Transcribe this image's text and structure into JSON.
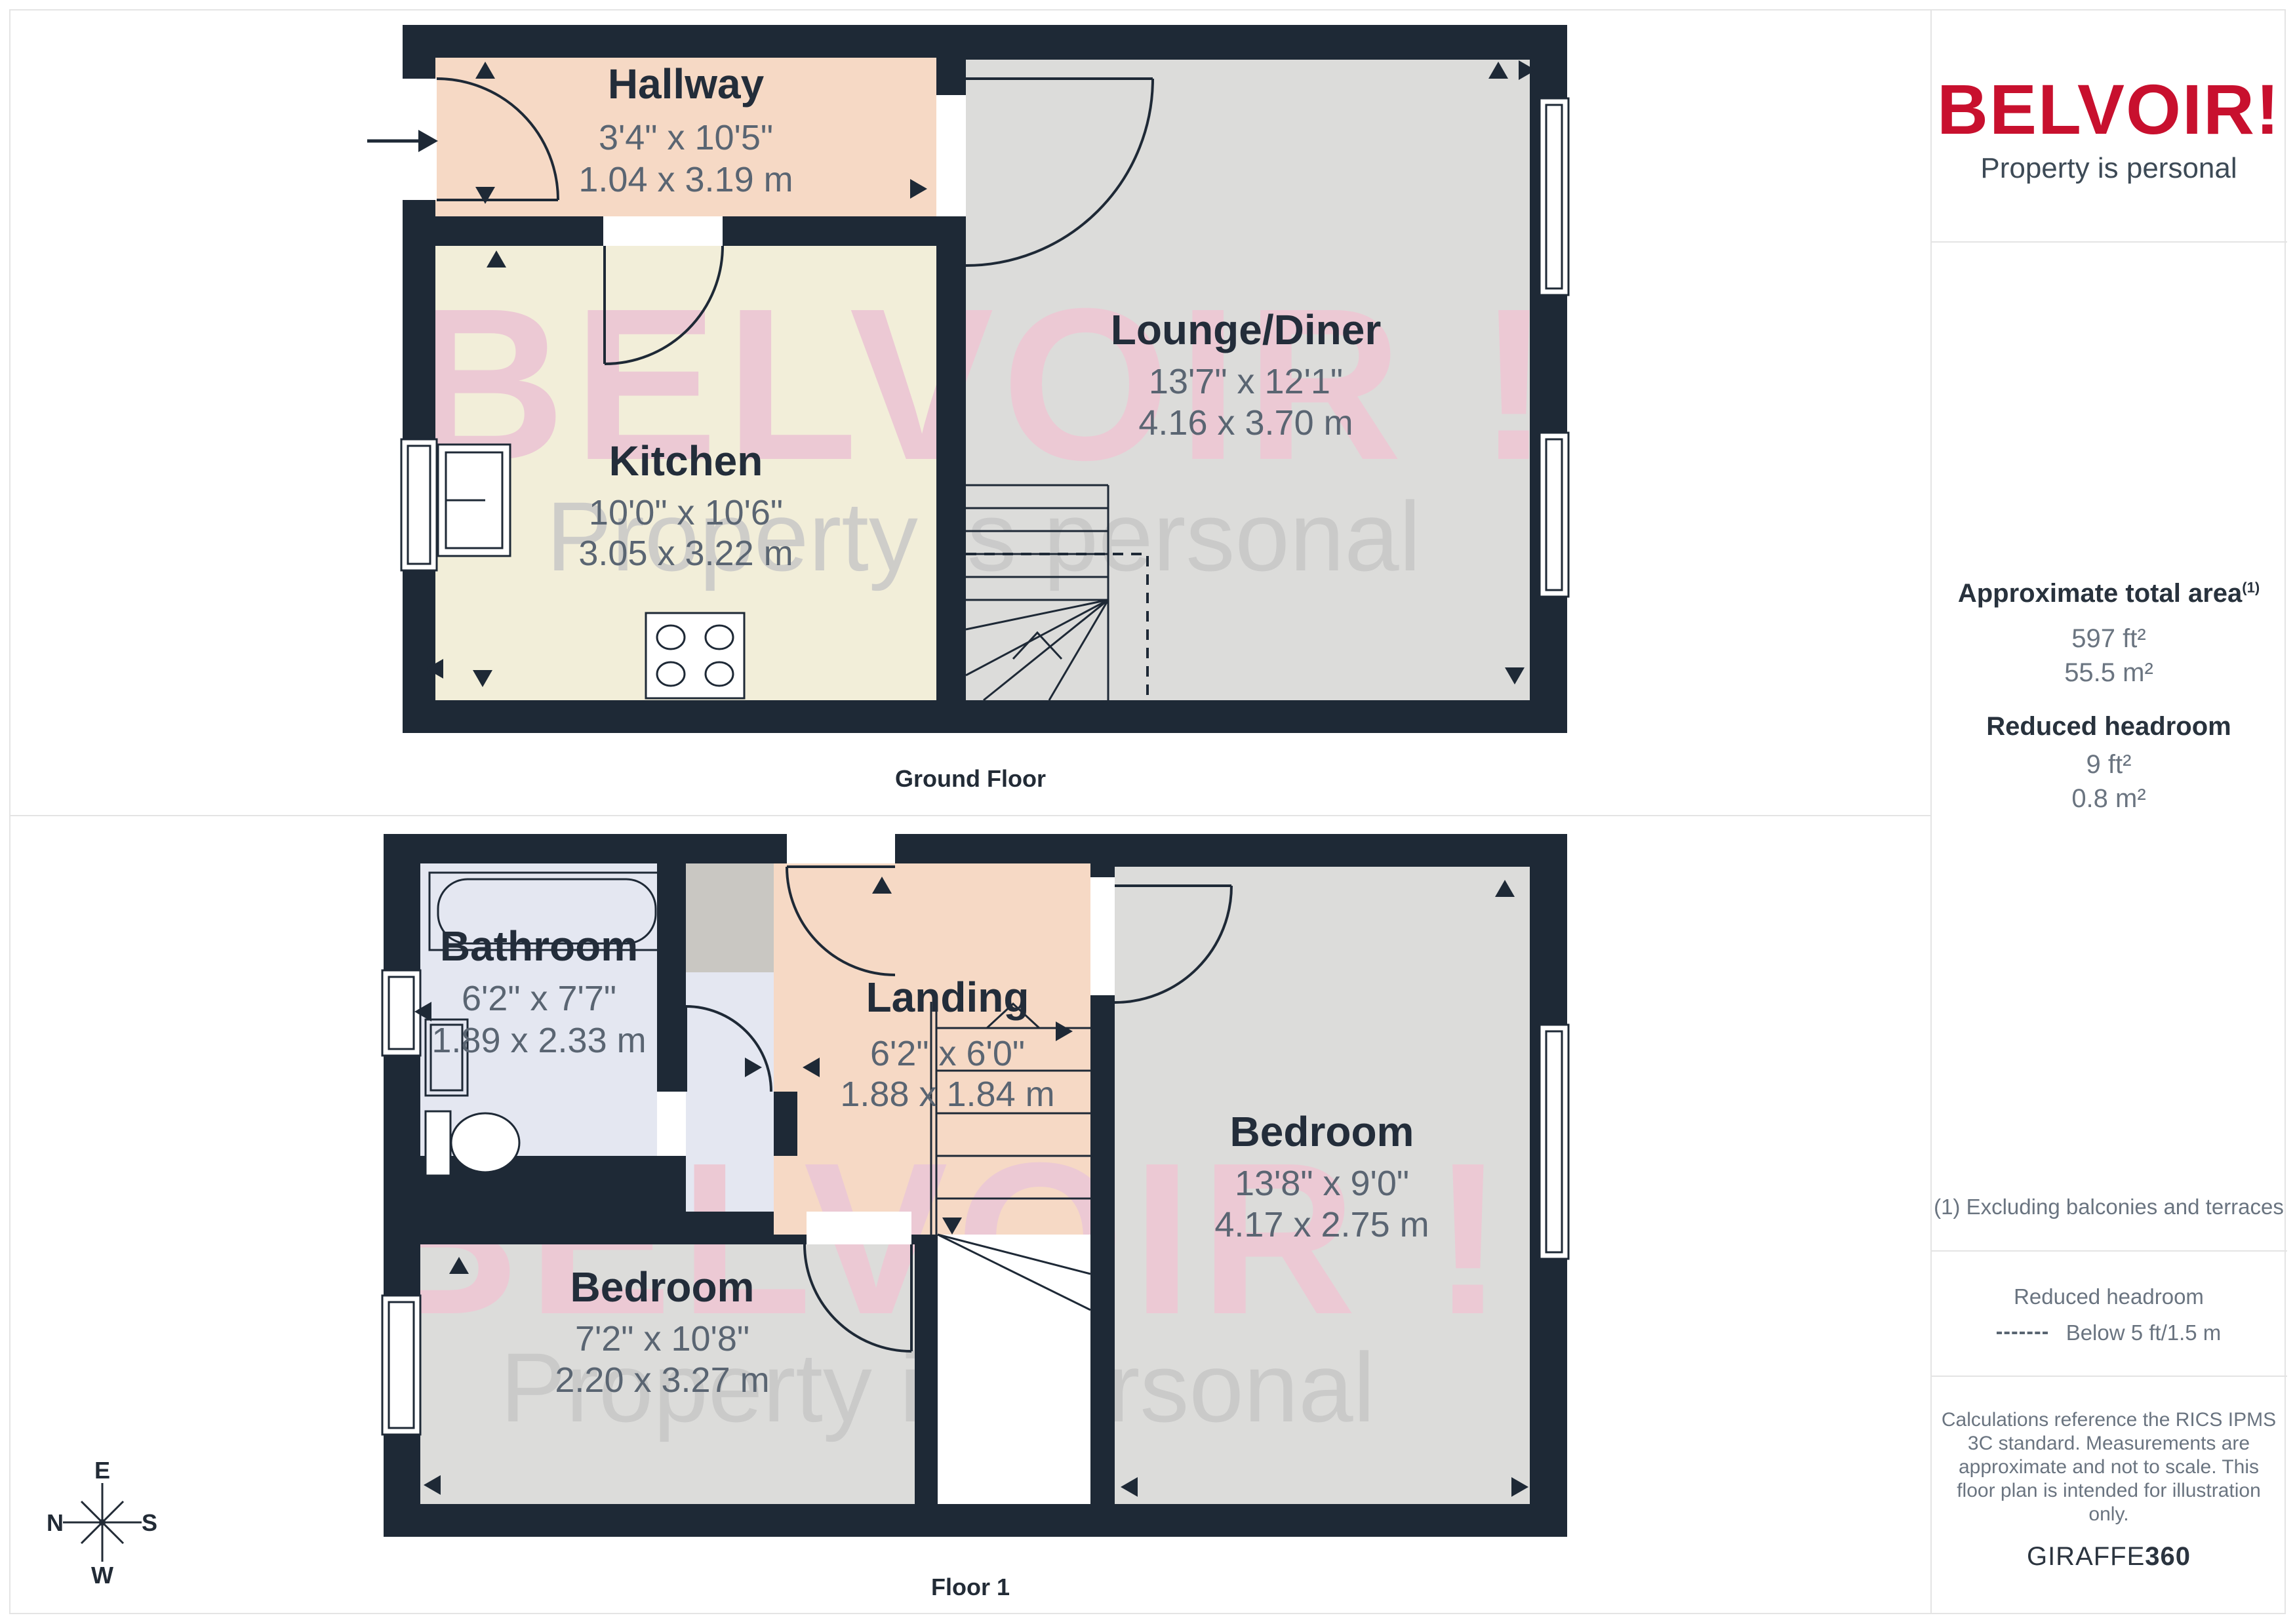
{
  "brand": {
    "logo": "BELVOIR!",
    "tagline": "Property is personal"
  },
  "watermark": {
    "brand": "BELVOIR !",
    "tagline": "Property is personal"
  },
  "floors": {
    "ground": {
      "label": "Ground Floor"
    },
    "first": {
      "label": "Floor 1"
    }
  },
  "rooms": {
    "hallway": {
      "name": "Hallway",
      "imperial": "3'4\" x 10'5\"",
      "metric": "1.04 x 3.19 m"
    },
    "kitchen": {
      "name": "Kitchen",
      "imperial": "10'0\" x 10'6\"",
      "metric": "3.05 x 3.22 m"
    },
    "lounge": {
      "name": "Lounge/Diner",
      "imperial": "13'7\" x 12'1\"",
      "metric": "4.16 x 3.70 m"
    },
    "bathroom": {
      "name": "Bathroom",
      "imperial": "6'2\" x 7'7\"",
      "metric": "1.89 x 2.33 m"
    },
    "landing": {
      "name": "Landing",
      "imperial": "6'2\" x 6'0\"",
      "metric": "1.88 x 1.84 m"
    },
    "bedroom_left": {
      "name": "Bedroom",
      "imperial": "7'2\" x 10'8\"",
      "metric": "2.20 x 3.27 m"
    },
    "bedroom_right": {
      "name": "Bedroom",
      "imperial": "13'8\" x 9'0\"",
      "metric": "4.17 x 2.75 m"
    }
  },
  "sidebar": {
    "area_title": "Approximate total area",
    "area_sup": "(1)",
    "area_ft": "597 ft²",
    "area_m": "55.5 m²",
    "reduced_title": "Reduced headroom",
    "reduced_ft": "9 ft²",
    "reduced_m": "0.8 m²",
    "note": "(1) Excluding balconies and terraces",
    "legend_title": "Reduced headroom",
    "legend_value": "Below 5 ft/1.5 m",
    "disclaimer": [
      "Calculations reference the RICS IPMS",
      "3C standard. Measurements are",
      "approximate and not to scale. This",
      "floor plan is intended for illustration",
      "only."
    ],
    "credit_regular": "GIRAFFE",
    "credit_bold": "360"
  },
  "compass": {
    "top": "E",
    "left": "N",
    "right": "S",
    "bottom": "W"
  },
  "colors": {
    "brand_red": "#c8102e",
    "wall": "#1e2936",
    "room_gray": "#dcdcda",
    "room_peach": "#f6d9c5",
    "room_cream": "#f2eed9",
    "room_blue": "#e4e7f1",
    "watermark_pink": "#ecc9d4"
  }
}
